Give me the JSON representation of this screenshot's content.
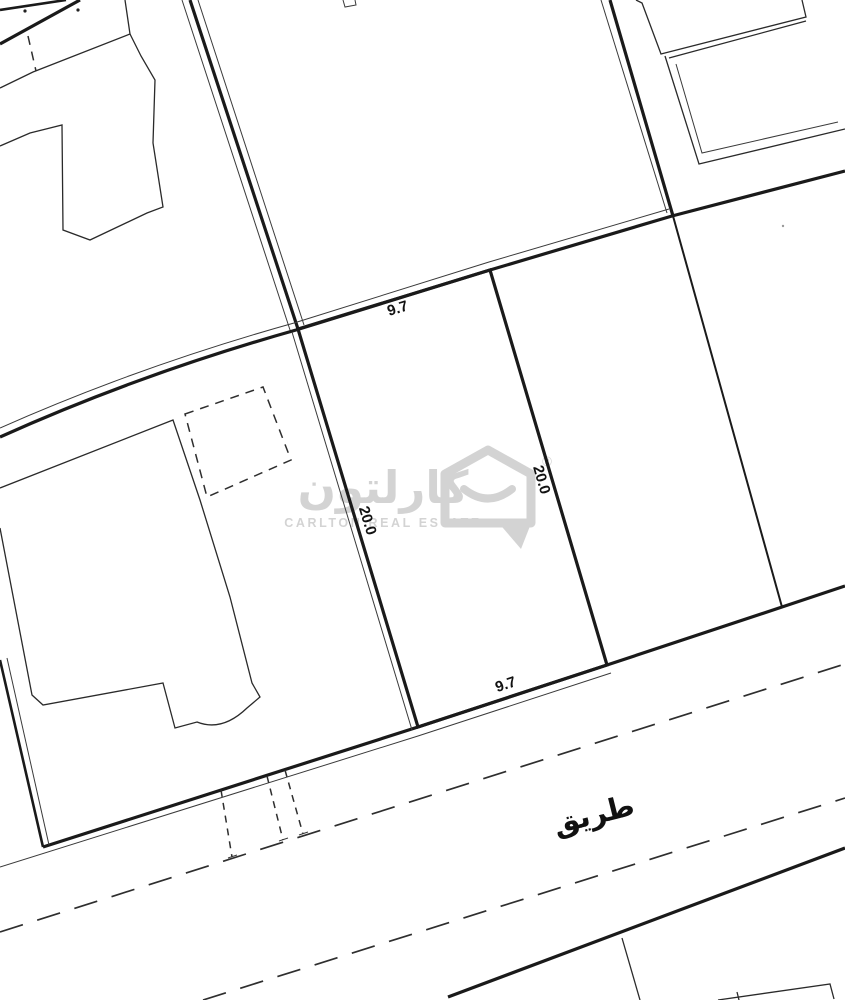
{
  "map": {
    "kind": "cadastral-survey-plot-map",
    "road_label": "طريق",
    "subject_plot": {
      "dimension_top": "9.7",
      "dimension_bottom": "9.7",
      "dimension_left": "20.0",
      "dimension_right": "20.0"
    },
    "watermark": {
      "brand_arabic": "كارلتون",
      "brand_english": "CARLTON REAL ESTATE",
      "registered_mark": "®"
    },
    "colors": {
      "line": "#1a1a1a",
      "watermark_gray": "#a9a9a9",
      "background": "#ffffff"
    }
  }
}
